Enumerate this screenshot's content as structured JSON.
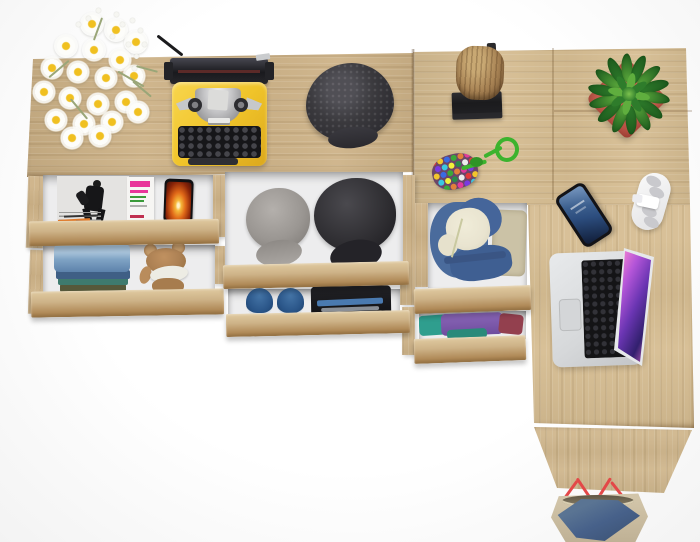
{
  "scene": {
    "type": "product-photo",
    "description": "Top-down render of a light oak sideboard and L-shaped desk combination with open tiered drawers filled with clothes and accessories, decorated with lifestyle props on a white background."
  },
  "colors": {
    "wood_base": "#cdb287",
    "wood_light": "#e0caa0",
    "wood_dark": "#b08a58",
    "wood_edge": "#8f6c3e",
    "desk_wood": "#d6bd92",
    "interior": "#ededee",
    "typewriter_yellow": "#f0c42a",
    "cap_charcoal": "#3a393d",
    "cap_gray": "#9a9692",
    "cap_black": "#2e2d31",
    "jeans_blue": "#7fa3c4",
    "olive": "#56583a",
    "teddy_brown": "#ad8154",
    "muzzle_cream": "#edece4",
    "plant_green_dark": "#2e7c2b",
    "plant_green_light": "#5fae3e",
    "pot_red": "#b84f43",
    "log_brown": "#a88354",
    "stand_black": "#1b1b1d",
    "laptop_silver": "#d6d8da",
    "key_black": "#141416",
    "screen_pink": "#ee7ed2",
    "screen_deep": "#32206e",
    "phone_screen_blue": "#2c4d7e",
    "flame_orange": "#e06818",
    "hoodie_blue": "#4a6b9c",
    "fleece_cream": "#e9e4d0",
    "khaki": "#cbc2a6",
    "shirt_purple": "#7a57a8",
    "shirt_teal": "#2f9e8e",
    "shirt_maroon": "#93404e",
    "shoe_blue": "#2a5588",
    "bag_beige": "#bfb195",
    "bag_denim": "#47618a",
    "strap": "#e34848",
    "mag_pink": "#e8359a",
    "mag_green": "#3a9a3a"
  },
  "items": [
    {
      "id": "sideboard-top",
      "label": "Sideboard top surface, light oak"
    },
    {
      "id": "desk-top",
      "label": "Desk top surface, light oak"
    },
    {
      "id": "desk-side-panel",
      "label": "Desk side panel"
    },
    {
      "id": "daisy-bouquet",
      "label": "Bouquet of white daisies"
    },
    {
      "id": "typewriter",
      "label": "Yellow vintage typewriter"
    },
    {
      "id": "flat-cap",
      "label": "Dark charcoal flat cap"
    },
    {
      "id": "log-decor",
      "label": "Wooden log decor on black stand"
    },
    {
      "id": "succulent",
      "label": "Green succulent in red pot"
    },
    {
      "id": "pompom-keychain",
      "label": "Multicolor pompom keychain with green cord"
    },
    {
      "id": "smartphone",
      "label": "Smartphone lying on desk"
    },
    {
      "id": "headphones",
      "label": "White folded headphones"
    },
    {
      "id": "laptop",
      "label": "Open silver laptop with colorful screen"
    },
    {
      "id": "tote-bag",
      "label": "Denim and beige tote bag with red straps"
    },
    {
      "id": "drawer-magazines",
      "label": "Open drawer with magazines and phone"
    },
    {
      "id": "drawer-jeans",
      "label": "Open drawer with folded jeans and teddy bear"
    },
    {
      "id": "drawer-caps",
      "label": "Open drawer with two caps"
    },
    {
      "id": "drawer-shoes",
      "label": "Open drawer with sneakers and folded dark clothes"
    },
    {
      "id": "drawer-hoodie",
      "label": "Open drawer with denim hoodie"
    },
    {
      "id": "drawer-shirts",
      "label": "Open drawer with folded colorful shirts"
    },
    {
      "id": "magazine-bw",
      "label": "Black and white fashion magazine"
    },
    {
      "id": "magazine-pink",
      "label": "Magazine with pink and green cover text"
    },
    {
      "id": "phone-flame",
      "label": "Phone showing flame picture"
    },
    {
      "id": "folded-jeans",
      "label": "Stack of folded jeans"
    },
    {
      "id": "teddy-bear",
      "label": "Brown teddy bear"
    },
    {
      "id": "cap-gray",
      "label": "Gray cadet cap"
    },
    {
      "id": "cap-black",
      "label": "Black cadet cap"
    },
    {
      "id": "sneakers",
      "label": "Pair of blue sneakers"
    },
    {
      "id": "dark-clothes",
      "label": "Folded dark clothes with blue stripe"
    },
    {
      "id": "denim-hoodie",
      "label": "Denim hoodie with cream fleece lining"
    },
    {
      "id": "folded-shirts",
      "label": "Folded purple, teal and maroon shirts"
    }
  ]
}
